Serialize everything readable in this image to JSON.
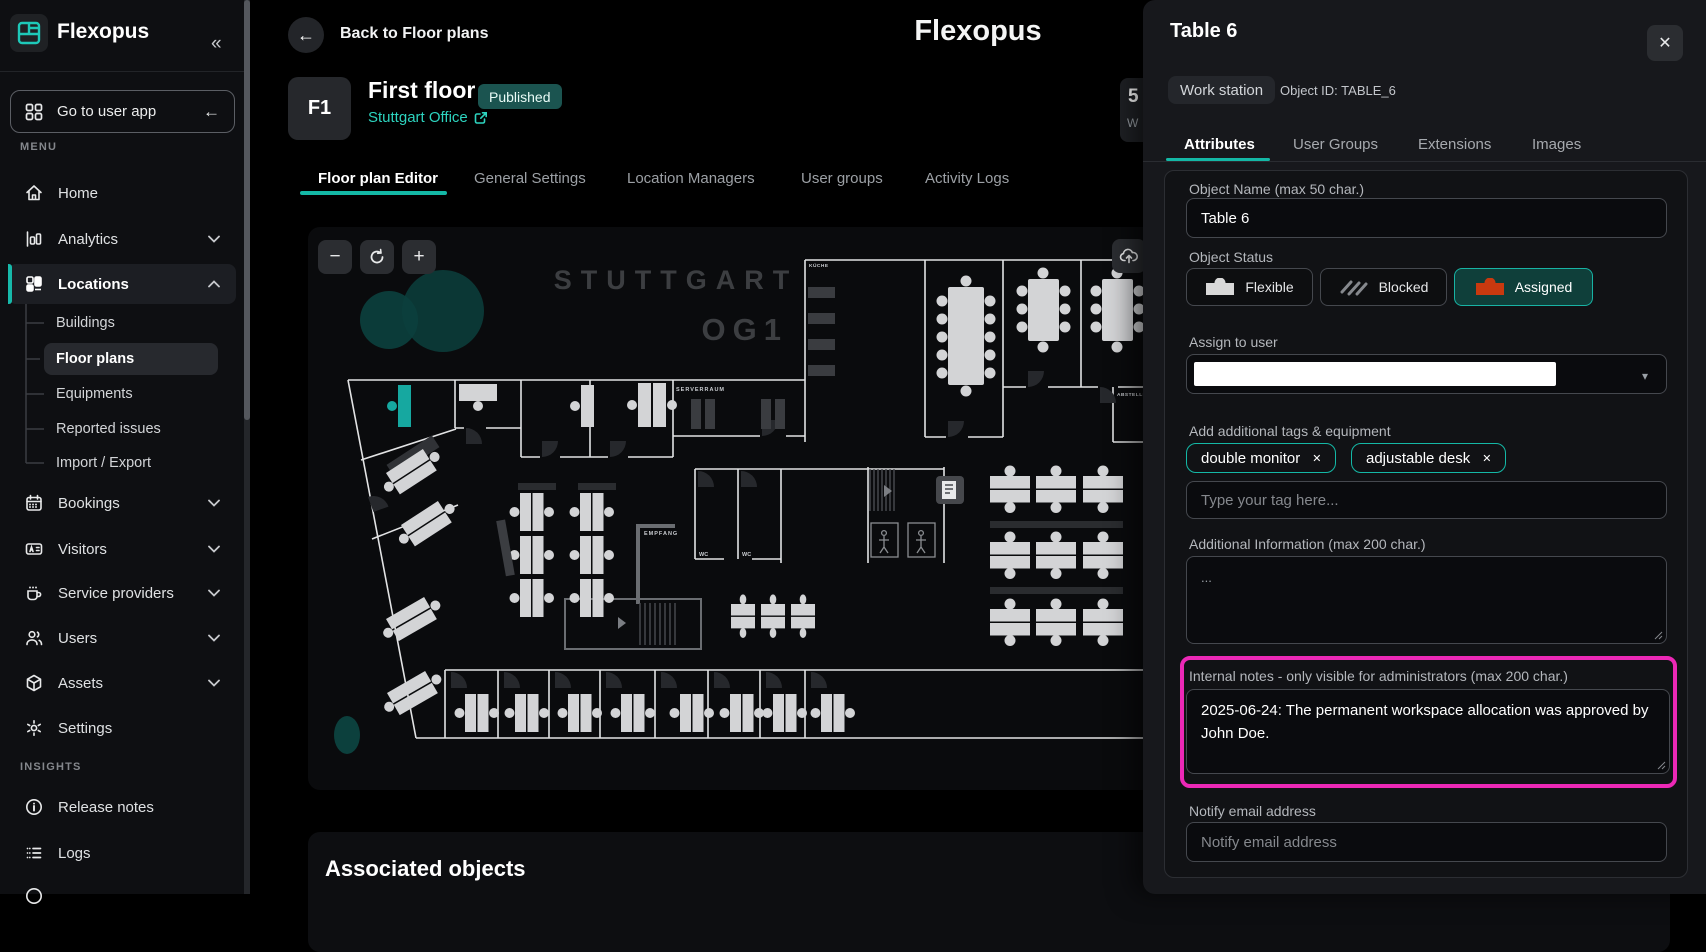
{
  "colors": {
    "accent": "#14b8a6",
    "highlight": "#ec28b6",
    "assigned_desk": "#c9390f",
    "published_bg": "#1b5450"
  },
  "sidebar": {
    "brand": "Flexopus",
    "collapse_icon": "«",
    "go_to_user_app": "Go to user app",
    "menu_label": "MENU",
    "items": [
      {
        "label": "Home"
      },
      {
        "label": "Analytics"
      },
      {
        "label": "Locations"
      },
      {
        "label": "Bookings"
      },
      {
        "label": "Visitors"
      },
      {
        "label": "Service providers"
      },
      {
        "label": "Users"
      },
      {
        "label": "Assets"
      },
      {
        "label": "Settings"
      }
    ],
    "locations_children": [
      "Buildings",
      "Floor plans",
      "Equipments",
      "Reported issues",
      "Import / Export"
    ],
    "insights_label": "INSIGHTS",
    "insights_items": [
      "Release notes",
      "Logs"
    ]
  },
  "header": {
    "back_label": "Back to Floor plans",
    "back_icon": "←",
    "app_title": "Flexopus",
    "floor_code": "F1",
    "floor_name": "First floor",
    "status_badge": "Published",
    "location_link": "Stuttgart Office",
    "tabs": [
      "Floor plan Editor",
      "General Settings",
      "Location Managers",
      "User groups",
      "Activity Logs"
    ],
    "clipped_fragment": {
      "line1": "5",
      "line2": "W"
    }
  },
  "floorplan": {
    "controls": {
      "zoom_out": "−",
      "zoom_in": "+"
    },
    "labels": {
      "city": "STUTTGART",
      "floor": "OG1",
      "server_room": "SERVERRAUM",
      "reception": "EMPFANG",
      "wc1": "WC",
      "wc2": "WC",
      "storage": "ABSTELLR",
      "kitchen": "KÜCHE"
    }
  },
  "associated": {
    "title": "Associated objects"
  },
  "panel": {
    "title": "Table 6",
    "type_badge": "Work station",
    "object_id": "Object ID: TABLE_6",
    "close_icon": "✕",
    "tabs": [
      "Attributes",
      "User Groups",
      "Extensions",
      "Images"
    ],
    "object_name": {
      "label": "Object Name (max 50 char.)",
      "value": "Table 6"
    },
    "object_status": {
      "label": "Object Status",
      "options": [
        {
          "label": "Flexible"
        },
        {
          "label": "Blocked"
        },
        {
          "label": "Assigned"
        }
      ]
    },
    "assign": {
      "label": "Assign to user",
      "caret": "▾"
    },
    "tags": {
      "label": "Add additional tags & equipment",
      "chips": [
        "double monitor",
        "adjustable desk"
      ],
      "remove_icon": "✕",
      "placeholder": "Type your tag here..."
    },
    "additional_info": {
      "label": "Additional Information (max 200 char.)",
      "value": "..."
    },
    "internal_notes": {
      "label": "Internal notes - only visible for administrators (max 200 char.)",
      "value": "2025-06-24: The permanent workspace allocation was approved by John Doe."
    },
    "notify": {
      "label": "Notify email address",
      "placeholder": "Notify email address"
    }
  }
}
